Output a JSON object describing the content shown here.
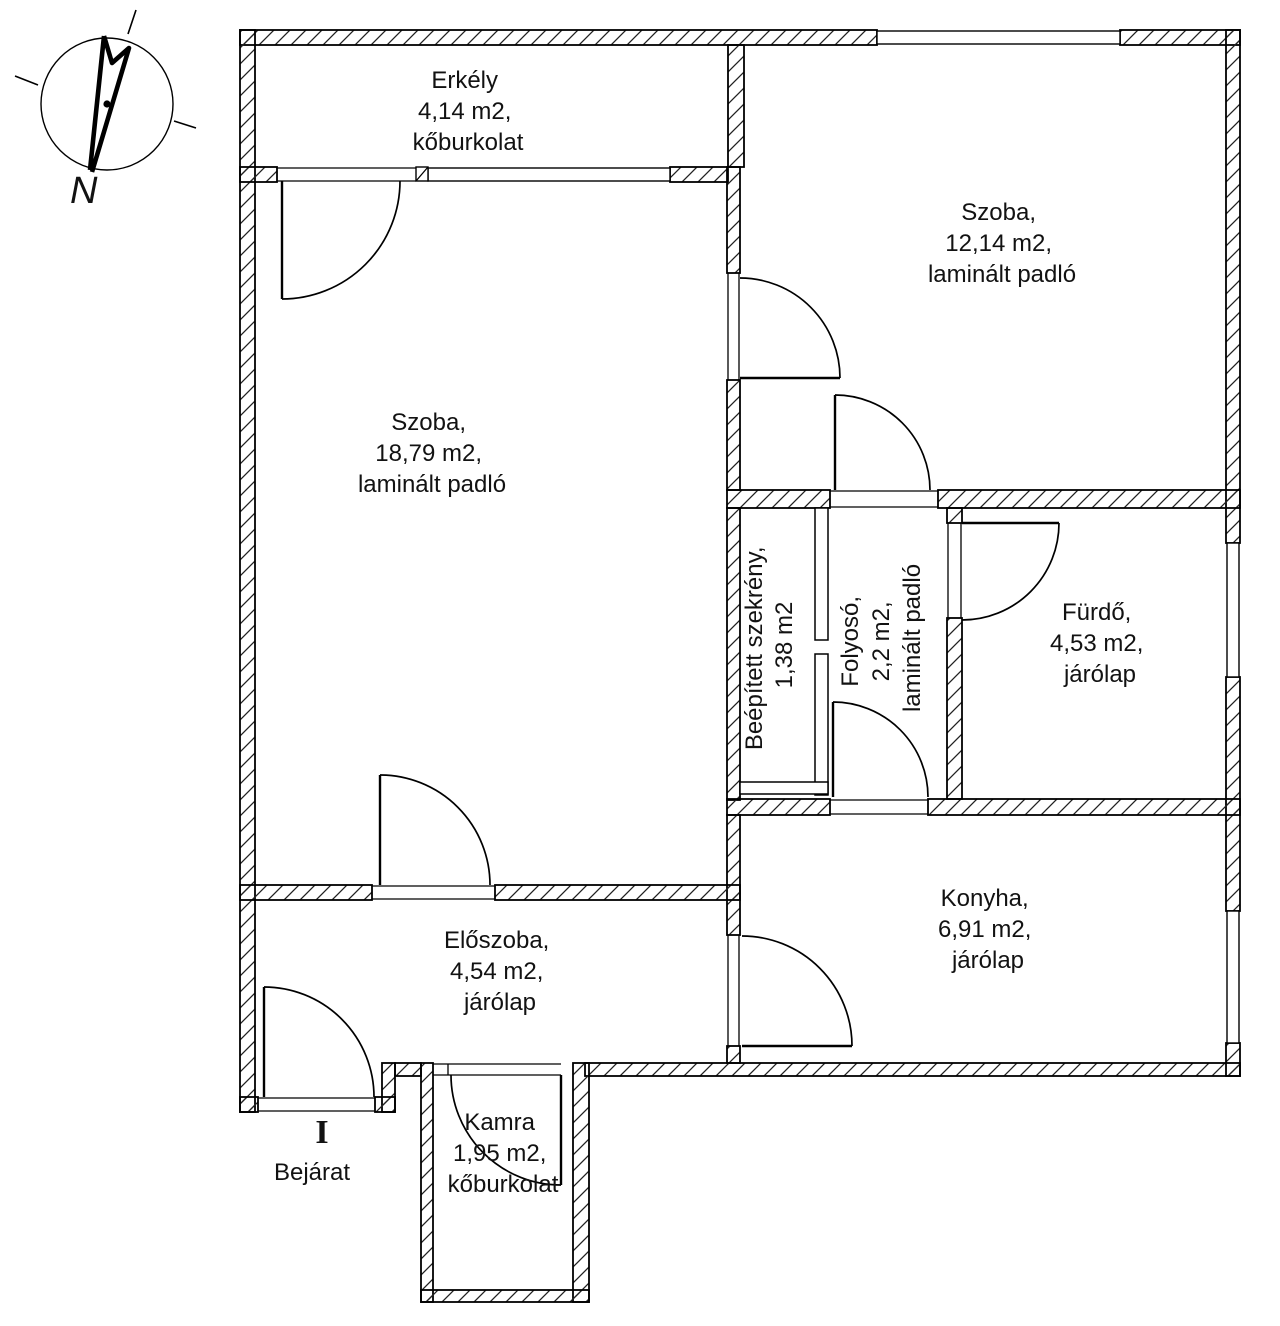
{
  "plan": {
    "title_hint": "apartment floor plan",
    "colors": {
      "wall": "#000000",
      "background": "#ffffff",
      "text": "#121212"
    },
    "compass": {
      "label": "N"
    },
    "entrance": {
      "label": "Bejárat",
      "threshold_symbol": "I"
    },
    "rooms": [
      {
        "id": "erkely",
        "name": "Erkély",
        "area": "4,14 m2",
        "flooring": "kőburkolat",
        "lines": [
          "Erkély",
          "4,14 m2,",
          "kőburkolat"
        ]
      },
      {
        "id": "szoba-nagy",
        "name": "Szoba",
        "area": "18,79 m2",
        "flooring": "laminált padló",
        "lines": [
          "Szoba,",
          "18,79 m2,",
          "laminált padló"
        ]
      },
      {
        "id": "szoba-kis",
        "name": "Szoba",
        "area": "12,14 m2",
        "flooring": "laminált padló",
        "lines": [
          "Szoba,",
          "12,14 m2,",
          "laminált padló"
        ]
      },
      {
        "id": "szekreny",
        "name": "Beépített szekrény",
        "area": "1,38 m2",
        "flooring": "",
        "lines": [
          "Beépített szekrény,",
          "1,38 m2"
        ]
      },
      {
        "id": "folyoso",
        "name": "Folyosó",
        "area": "2,2 m2",
        "flooring": "laminált padló",
        "lines": [
          "Folyosó,",
          "2,2 m2,",
          "laminált padló"
        ]
      },
      {
        "id": "furdo",
        "name": "Fürdő",
        "area": "4,53 m2",
        "flooring": "járólap",
        "lines": [
          "Fürdő,",
          "4,53 m2,",
          "járólap"
        ]
      },
      {
        "id": "konyha",
        "name": "Konyha",
        "area": "6,91 m2",
        "flooring": "járólap",
        "lines": [
          "Konyha,",
          "6,91 m2,",
          "járólap"
        ]
      },
      {
        "id": "eloszoba",
        "name": "Előszoba",
        "area": "4,54 m2",
        "flooring": "járólap",
        "lines": [
          "Előszoba,",
          "4,54 m2,",
          "járólap"
        ]
      },
      {
        "id": "kamra",
        "name": "Kamra",
        "area": "1,95 m2",
        "flooring": "kőburkolat",
        "lines": [
          "Kamra",
          "1,95 m2,",
          "kőburkolat"
        ]
      }
    ]
  }
}
